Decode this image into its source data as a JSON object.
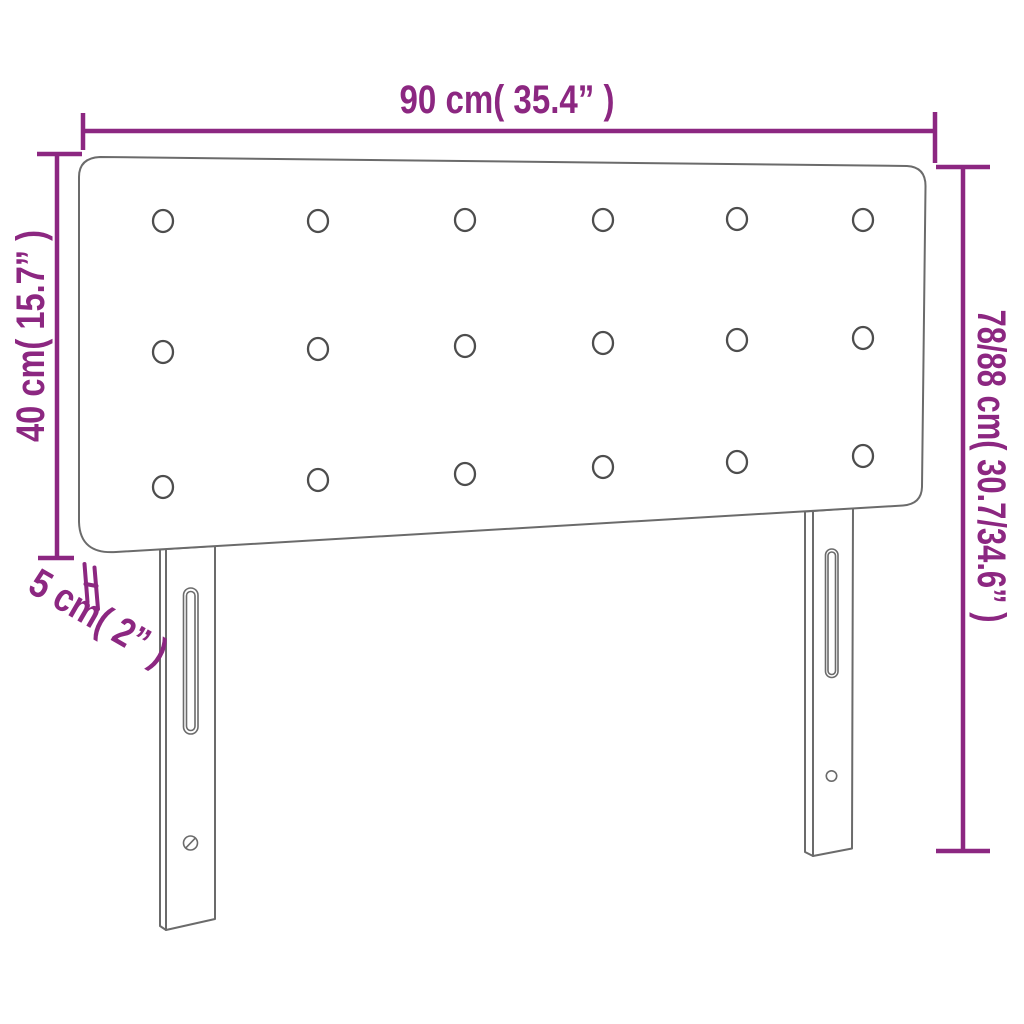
{
  "product": {
    "name": "headboard",
    "button_grid": {
      "rows": 3,
      "columns": 6
    },
    "legs": 2
  },
  "dimensions": {
    "width_top": "90 cm( 35.4” )",
    "height_left": "40 cm( 15.7” )",
    "height_right": "78/88 cm( 30.7/34.6” )",
    "thickness": "5 cm( 2” )"
  },
  "colors": {
    "dimension_annotation": "#8c2781",
    "product_outline": "#6b6b6b",
    "button_outline": "#4d4d4d",
    "background": "#ffffff"
  }
}
